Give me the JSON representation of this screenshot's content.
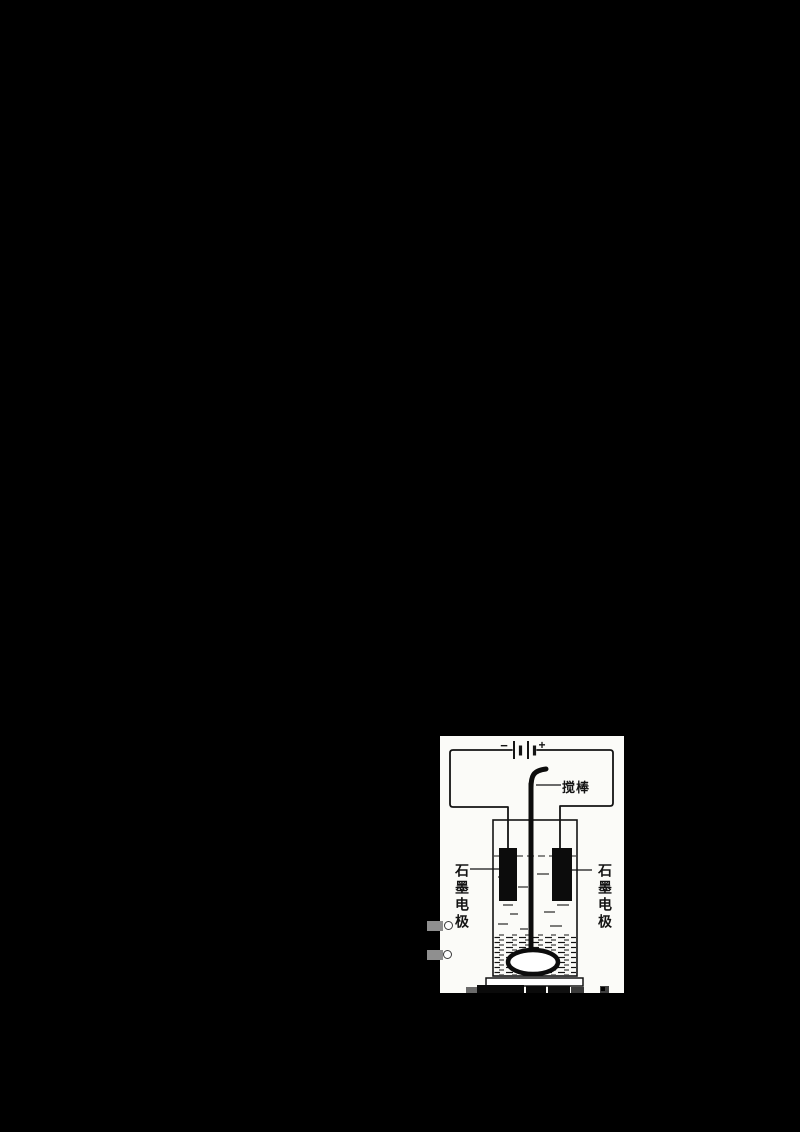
{
  "page": {
    "background_color": "#000000",
    "paper_color": "#fbfbf8",
    "ink_color": "#141414"
  },
  "figure": {
    "type": "electrolysis-apparatus-diagram",
    "labels": {
      "stir_rod": "搅棒",
      "left_electrode": "石墨电极",
      "right_electrode": "石墨电极",
      "battery_minus": "−",
      "battery_plus": "+"
    }
  }
}
